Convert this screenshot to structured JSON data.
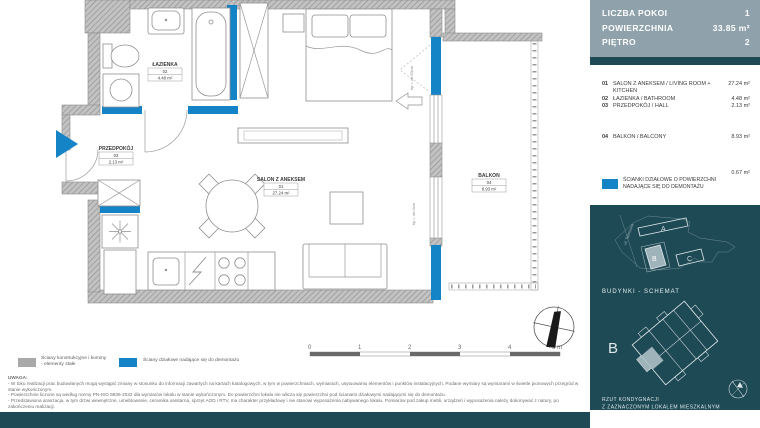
{
  "colors": {
    "accent_blue": "#1484C6",
    "dark_teal": "#1E4A55",
    "header_slate": "#8FA2AB",
    "wall_gray": "#A9A9A9",
    "highlight_unit": "#9FB3BB"
  },
  "plan": {
    "rooms": {
      "salon": {
        "name": "SALON Z ANEKSEM",
        "no": "01",
        "area": "27.24 m²"
      },
      "lazienka": {
        "name": "ŁAZIENKA",
        "no": "02",
        "area": "4.48 m²"
      },
      "przedpokoj": {
        "name": "PRZEDPOKÓJ",
        "no": "03",
        "area": "2.13 m²"
      },
      "balkon": {
        "name": "BALKON",
        "no": "04",
        "area": "8.93 m²"
      }
    },
    "annotations": {
      "sill_50": "hp = ok.50cm",
      "sill_0": "hp = ok.0cm"
    },
    "scale_bar": {
      "t0": "0",
      "t1": "1",
      "t2": "2",
      "t3": "3",
      "t4": "4",
      "t5": "5 m"
    },
    "legend": {
      "structural": {
        "line1": "Ściany konstrukcyjne i kominy",
        "line2": "- elementy stałe"
      },
      "partition": {
        "label": "Ściany działowe nadające się do demontażu"
      }
    },
    "notes": {
      "title": "UWAGA:",
      "items": [
        "- W toku realizacji prac budowlanych mogą wystąpić zmiany w stosunku do informacji zawartych na kartach katalogowych, w tym w powierzchniach, wymiarach, usytuowaniu elementów i punktów instalacyjnych. Podane wymiary są wymiarami w świetle pionowych przegród w stanie wykończonym.",
        "- Powierzchnie liczone są według normy PN-ISO 9836-2022 dla wymiarów lokalu w stanie wykończonym. Do powierzchni lokalu nie wlicza się powierzchni pod ścianami działowymi nadającymi się do demontażu.",
        "- Przedstawiona aranżacja, w tym drzwi wewnętrzne, umeblowanie, ceramika sanitarna, sprzęt AGD i RTV, ma charakter przykładowy i nie stanowi wyposażenia nabywanego lokalu. Pomiarów pod zakup mebli, urządzeń i wyposażenia należy dokonywać z natury, po zakończeniu realizacji."
      ]
    }
  },
  "sidebar": {
    "header": {
      "rows": [
        {
          "label": "LICZBA POKOI",
          "value": "1"
        },
        {
          "label": "POWIERZCHNIA",
          "value": "33.85 m²"
        },
        {
          "label": "PIĘTRO",
          "value": "2"
        }
      ]
    },
    "room_list": [
      {
        "no": "01",
        "name": "SALON Z ANEKSEM / LIVING ROOM + KITCHEN",
        "area": "27.24 m²"
      },
      {
        "no": "02",
        "name": "ŁAZIENKA / BATHROOM",
        "area": "4.48 m²"
      },
      {
        "no": "03",
        "name": "PRZEDPOKÓJ / HALL",
        "area": "2.13 m²"
      },
      {
        "no": "04",
        "name": "BALKON / BALCONY",
        "area": "8.93 m²"
      }
    ],
    "partition_note": {
      "line1": "ŚCIANKI DZIAŁOWE O POWIERZCHNI",
      "line2": "NADAJĄCE SIĘ DO DEMONTAŻU",
      "area": "0.67 m²"
    },
    "buildings": {
      "caption": "BUDYNKI - SCHEMAT",
      "street": "ul. Taśmowa",
      "a": "A",
      "b": "B",
      "c": "C"
    },
    "floor_schematic": {
      "letter": "B",
      "caption1": "RZUT KONDYGNACJI",
      "caption2": "Z ZAZNACZONYM LOKALEM MIESZKALNYM"
    }
  }
}
